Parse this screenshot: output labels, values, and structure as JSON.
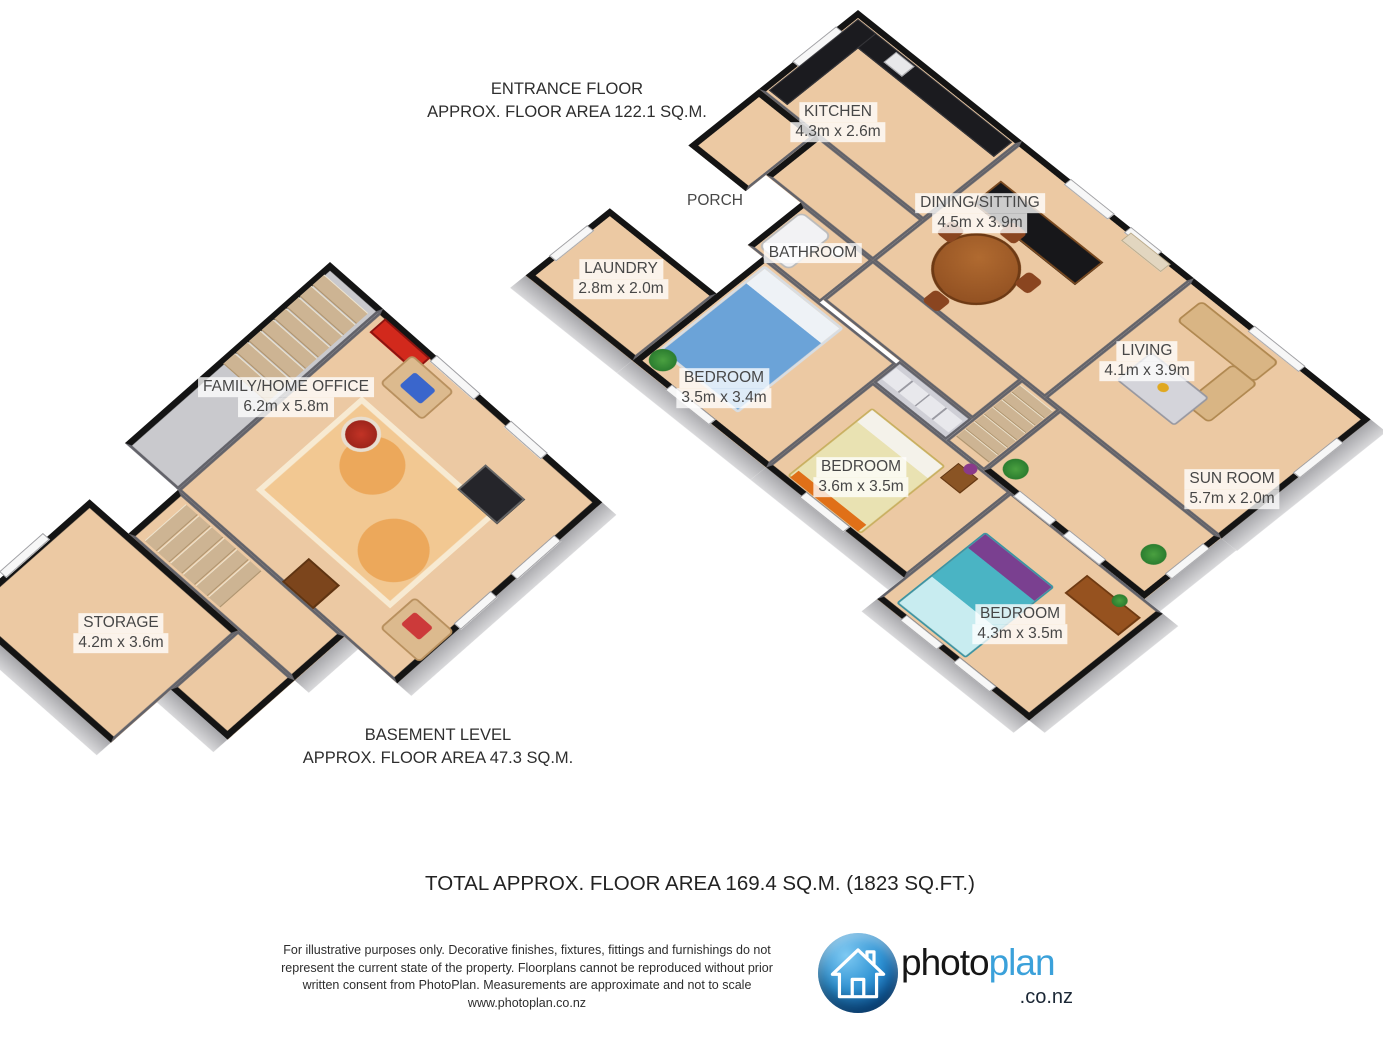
{
  "headers": {
    "entrance": {
      "line1": "ENTRANCE FLOOR",
      "line2": "APPROX. FLOOR AREA 122.1 SQ.M."
    },
    "basement": {
      "line1": "BASEMENT LEVEL",
      "line2": "APPROX. FLOOR AREA 47.3 SQ.M."
    },
    "total": "TOTAL APPROX. FLOOR AREA 169.4 SQ.M. (1823 SQ.FT.)"
  },
  "rooms": {
    "kitchen": {
      "name": "KITCHEN",
      "dims": "4.3m x 2.6m"
    },
    "dining": {
      "name": "DINING/SITTING",
      "dims": "4.5m x 3.9m"
    },
    "porch": {
      "name": "PORCH"
    },
    "bathroom": {
      "name": "BATHROOM"
    },
    "laundry": {
      "name": "LAUNDRY",
      "dims": "2.8m x 2.0m"
    },
    "bedroom1": {
      "name": "BEDROOM",
      "dims": "3.5m x 3.4m"
    },
    "bedroom2": {
      "name": "BEDROOM",
      "dims": "3.6m x 3.5m"
    },
    "living": {
      "name": "LIVING",
      "dims": "4.1m x 3.9m"
    },
    "sunroom": {
      "name": "SUN ROOM",
      "dims": "5.7m x 2.0m"
    },
    "bedroom3": {
      "name": "BEDROOM",
      "dims": "4.3m x 3.5m"
    },
    "family": {
      "name": "FAMILY/HOME OFFICE",
      "dims": "6.2m x 5.8m"
    },
    "storage": {
      "name": "STORAGE",
      "dims": "4.2m x 3.6m"
    }
  },
  "footer": {
    "line1": "For illustrative purposes only. Decorative finishes, fixtures, fittings and furnishings do not",
    "line2": "represent the current state of the property. Floorplans cannot be reproduced without prior",
    "line3": "written consent from PhotoPlan. Measurements are approximate and not to scale",
    "website": "www.photoplan.co.nz",
    "logo": {
      "brand_photo": "photo",
      "brand_plan": "plan",
      "brand_suffix": ".co.nz"
    }
  },
  "colors": {
    "floor_tan": "#ecc9a3",
    "exterior_wall": "#141414",
    "interior_wall": "#63636a",
    "logo_blue": "#3ba1da",
    "label_text": "#474747"
  }
}
